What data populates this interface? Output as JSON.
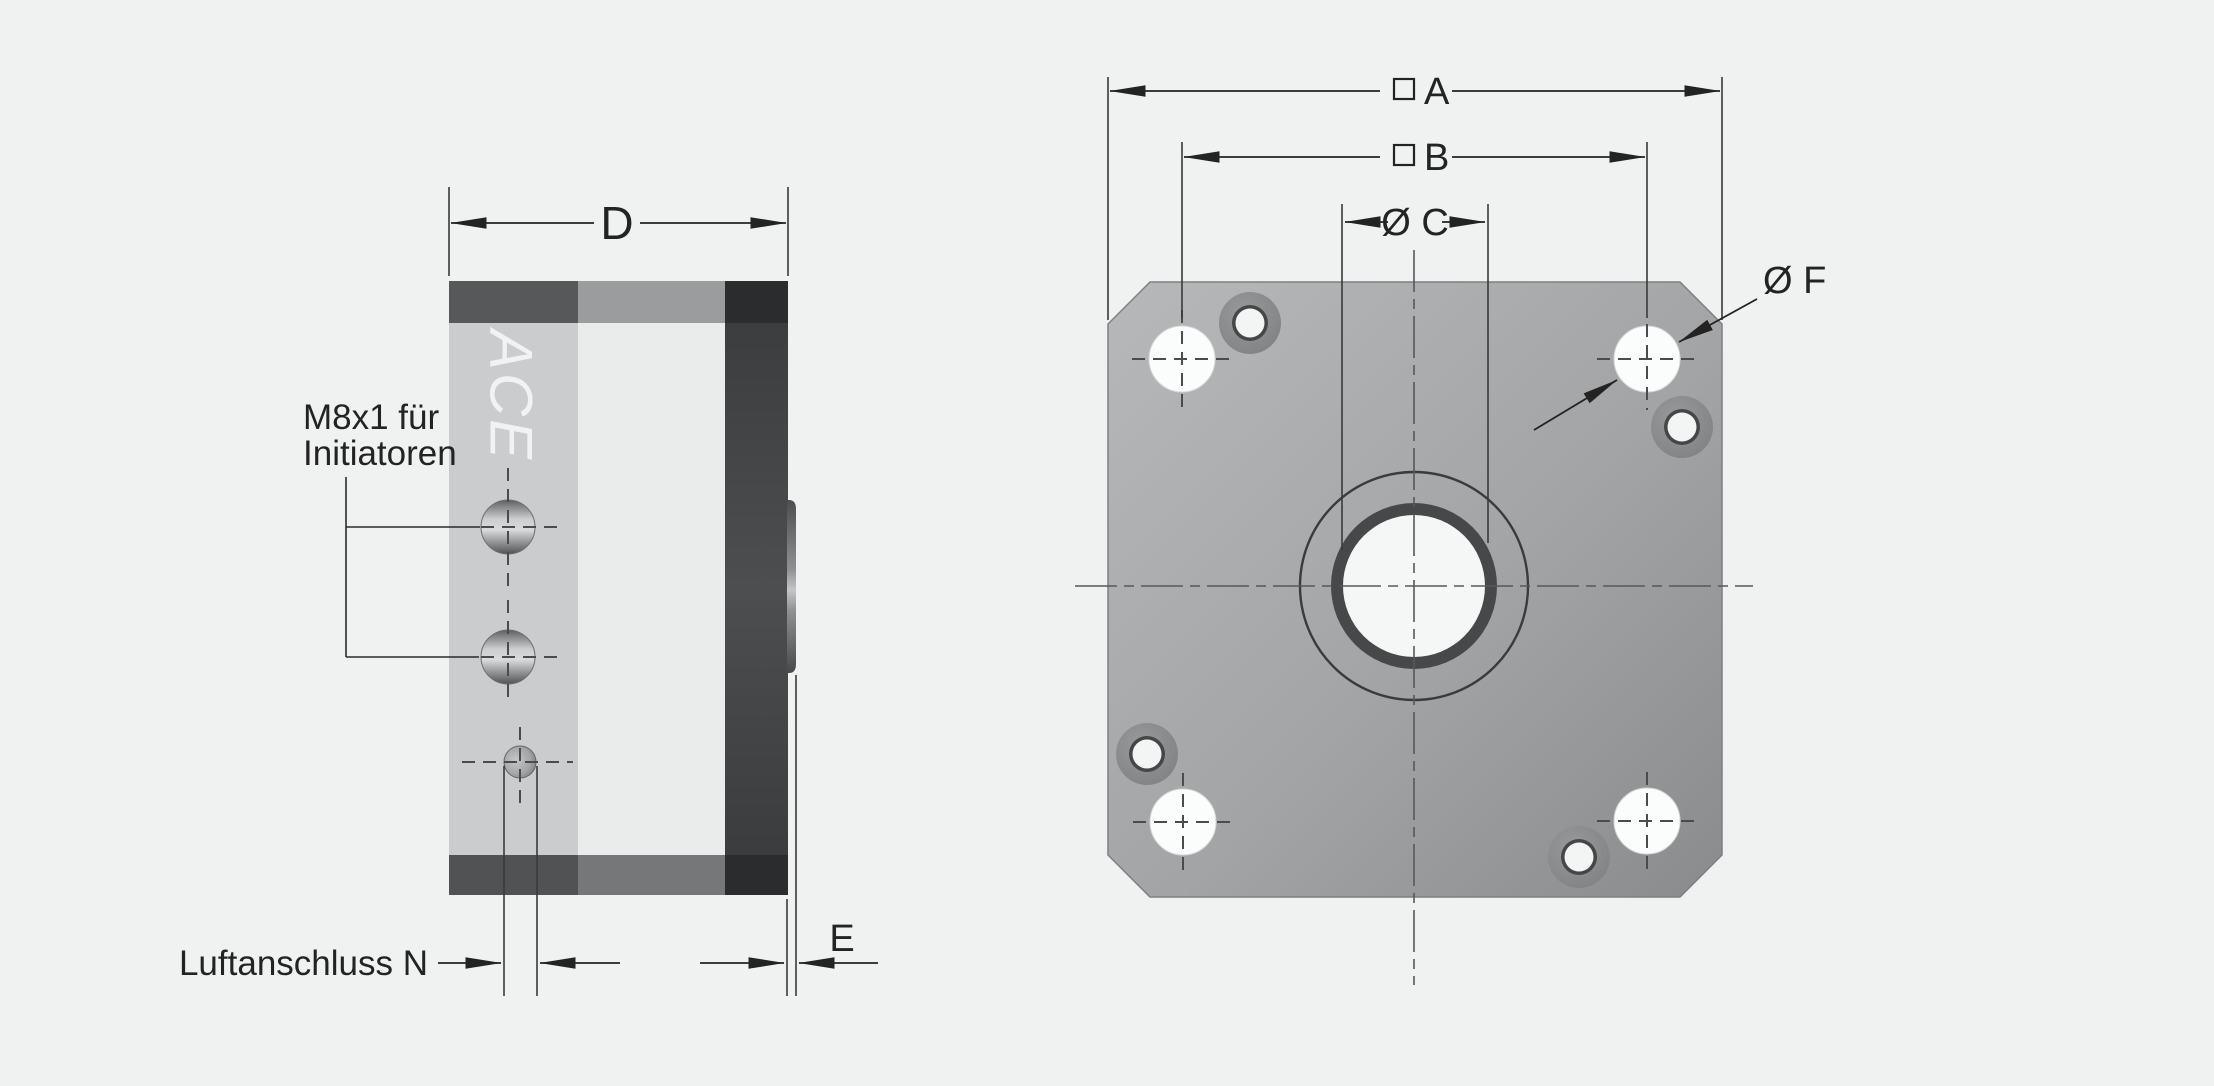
{
  "page": {
    "background": "#f0f1f1"
  },
  "drawing": {
    "side_view": {
      "logo_text": "ACE",
      "dim_d_label": "D",
      "dim_e_label": "E",
      "air_note_label": "Luftanschluss N",
      "sensor_note_line1": "M8x1 für",
      "sensor_note_line2": "Initiatoren"
    },
    "front_view": {
      "dim_a_label": "A",
      "dim_a_symbol": "□",
      "dim_b_label": "B",
      "dim_b_symbol": "□",
      "dim_c_label": "Ø C",
      "dim_f_label": "Ø F"
    },
    "colors": {
      "background": "#f0f1f1",
      "line": "#232323",
      "dashed_line": "#4a4b4d",
      "plate_light": "#b7b8ba",
      "plate_dark": "#8a8c8e",
      "block_strip_light": "#cbcccd",
      "block_strip_lighter": "#eaebeb",
      "block_strip_dark": "#47484a",
      "cap_top_left": "#57585a",
      "cap_top_mid": "#9a9c9e",
      "cap_top_right": "#2b2c2d",
      "hole_white": "#fbfcfc"
    }
  }
}
